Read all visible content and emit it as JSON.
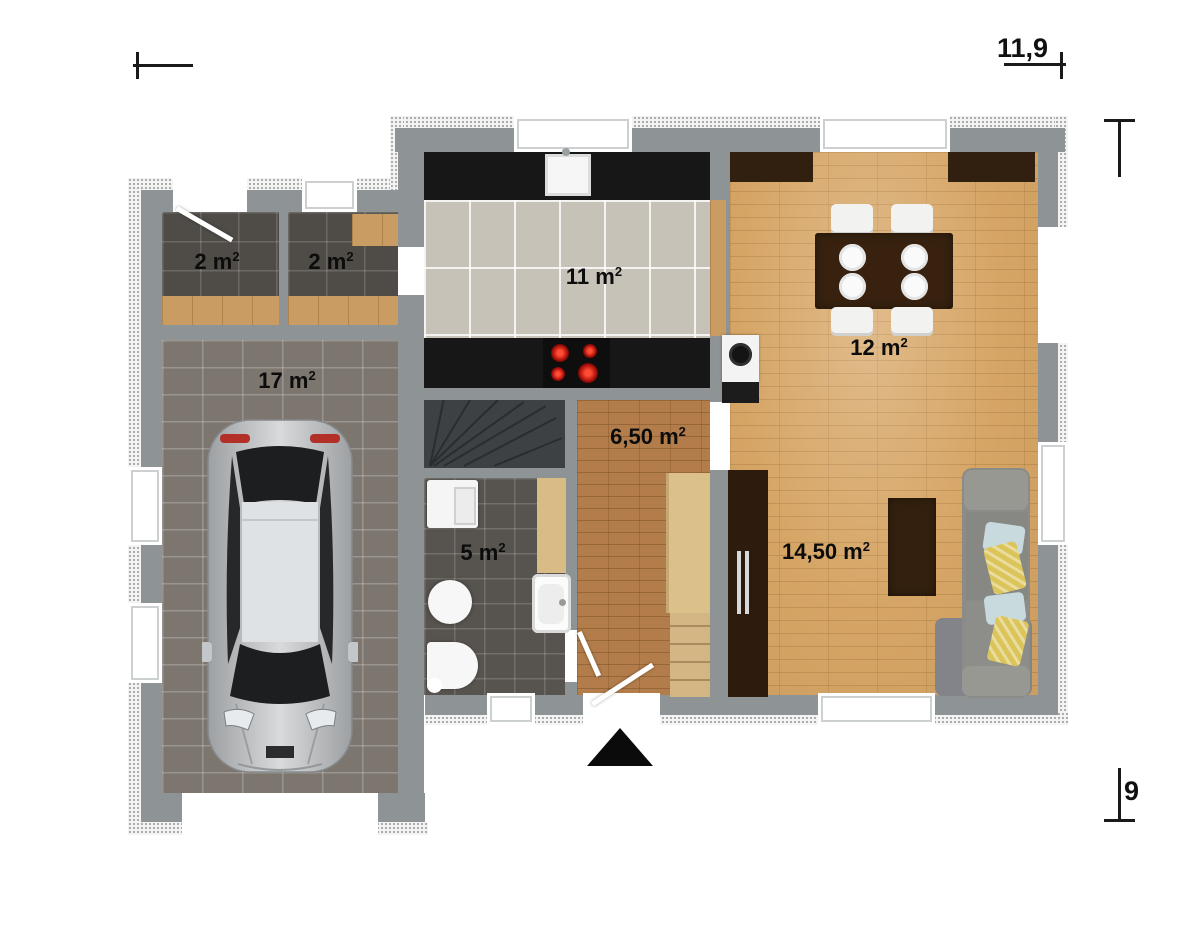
{
  "plan": {
    "type": "floor-plan",
    "dimension_labels": {
      "width": "11,9",
      "height": "9"
    },
    "rooms": {
      "storage_left": {
        "area": "2 m",
        "sup": "2"
      },
      "storage_right": {
        "area": "2 m",
        "sup": "2"
      },
      "garage": {
        "area": "17 m",
        "sup": "2"
      },
      "kitchen": {
        "area": "11 m",
        "sup": "2"
      },
      "dining": {
        "area": "12 m",
        "sup": "2"
      },
      "hall": {
        "area": "6,50 m",
        "sup": "2"
      },
      "bathroom": {
        "area": "5 m",
        "sup": "2"
      },
      "living": {
        "area": "14,50 m",
        "sup": "2"
      }
    },
    "colors": {
      "wall": "#8e9495",
      "parquet": "#d6a565",
      "hall_wood": "#b27d4a",
      "dark_tile": "#4f4b46",
      "garage_tile": "#7c766f",
      "kitchen_tile": "#c6c2b8",
      "counter": "#171717",
      "dark_furniture": "#31200f",
      "sofa": "#8b8b87",
      "pillow_yellow": "#dbc55b",
      "pillow_blue": "#c8dade",
      "stairs": "#3d4144",
      "car_body": "#b9bcbe",
      "burner_red": "#d01910"
    }
  }
}
